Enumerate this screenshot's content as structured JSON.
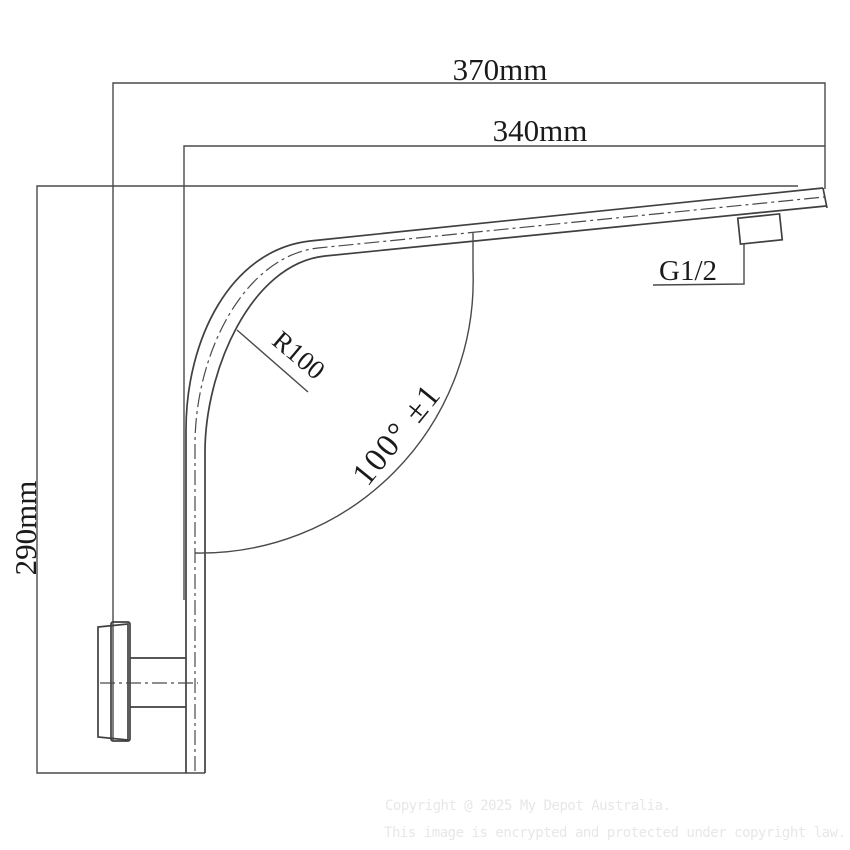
{
  "drawing": {
    "dimensions": {
      "overall_width": "370mm",
      "arm_width": "340mm",
      "height": "290mm",
      "bend_radius": "R100",
      "bend_angle": "100° ±1",
      "thread": "G1/2"
    },
    "watermark": {
      "line1": "Copyright @ 2025 My Depot Australia.",
      "line2": "This image is encrypted and protected under copyright law."
    },
    "colors": {
      "line": "#404040",
      "text": "#1a1a1a",
      "watermark": "#e7e7e7",
      "background": "#ffffff"
    }
  }
}
